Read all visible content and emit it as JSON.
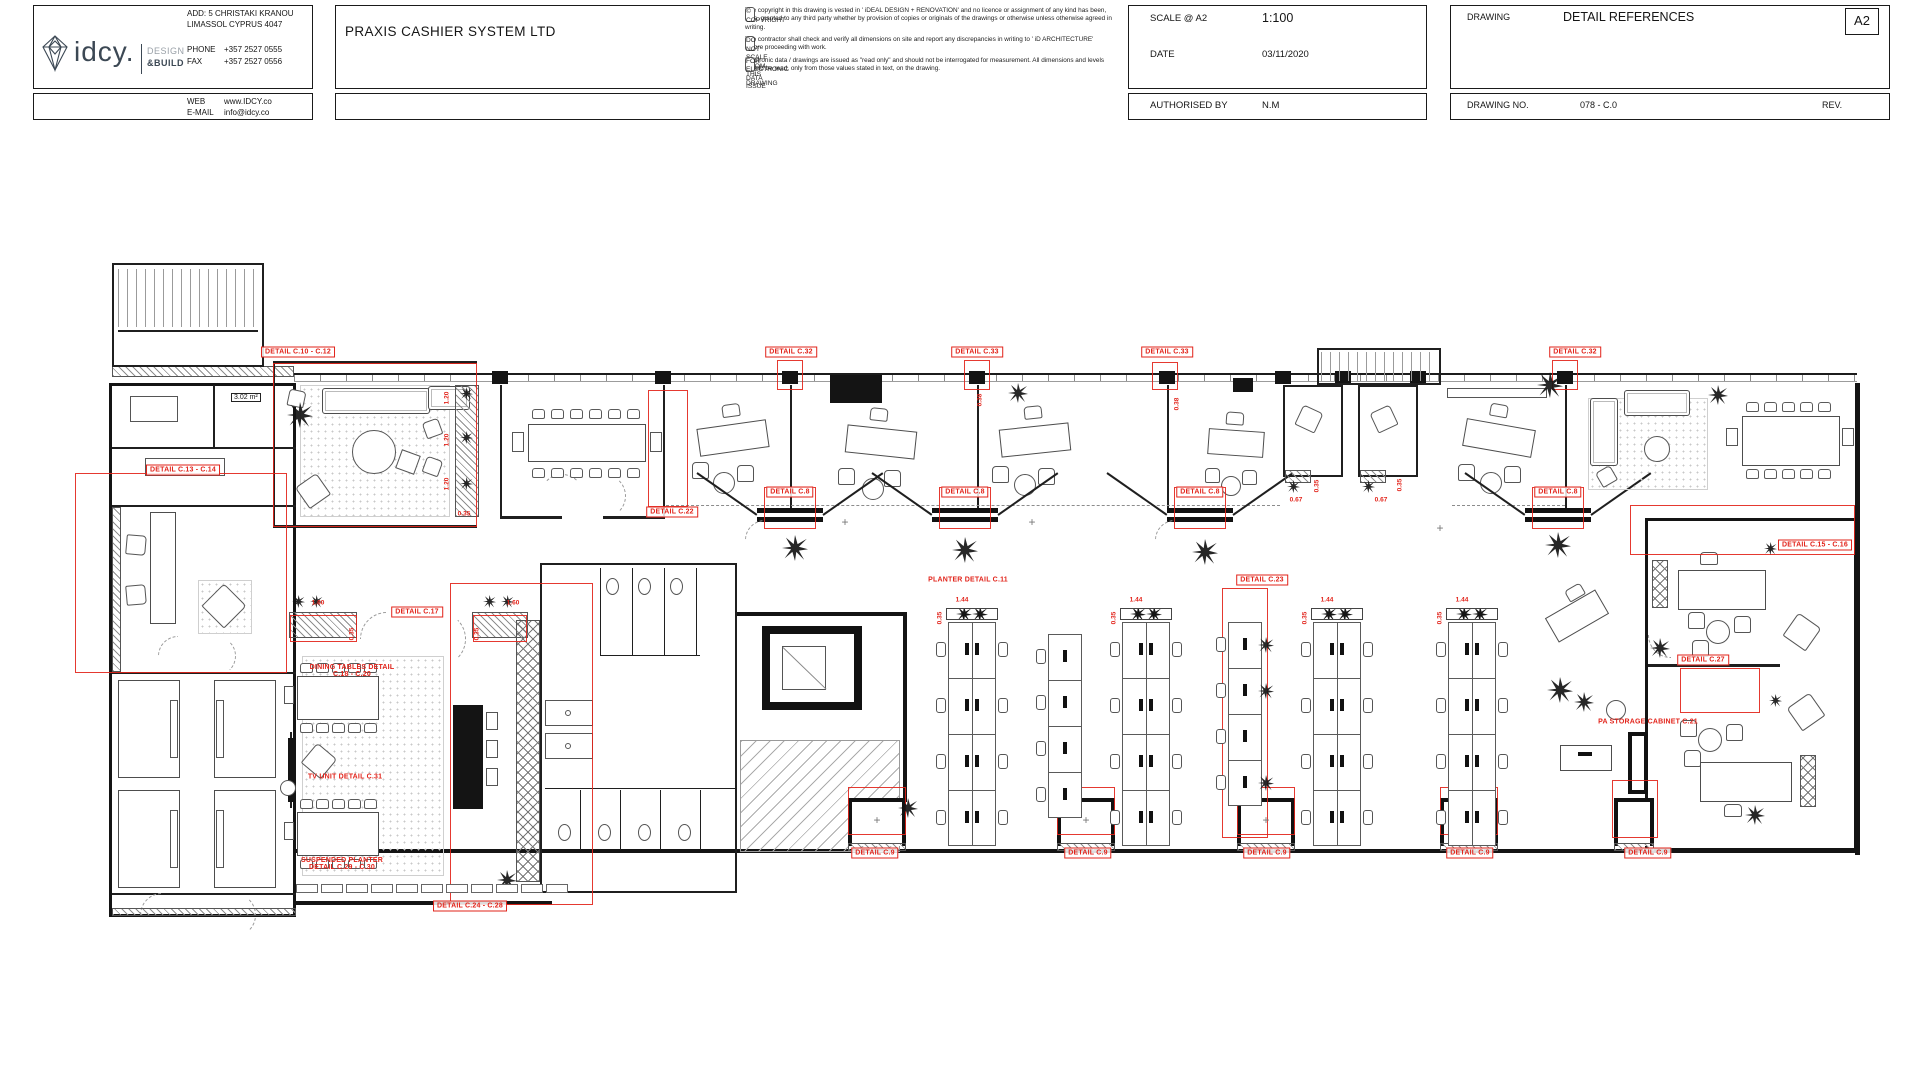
{
  "colors": {
    "annotation_red": "#e2231a",
    "wall_black": "#1a1a1a"
  },
  "brand": {
    "logo_text": "idcy.",
    "tag1": "DESIGN",
    "tag2": "&BUILD"
  },
  "contact": {
    "add1": "ADD: 5 CHRISTAKI KRANOU",
    "add2": "LIMASSOL CYPRUS 4047",
    "phone_label": "PHONE",
    "phone": "+357 2527 0555",
    "fax_label": "FAX",
    "fax": "+357 2527 0556",
    "web_label": "WEB",
    "web": "www.IDCY.co",
    "email_label": "E-MAIL",
    "email": "info@idcy.co"
  },
  "project": {
    "client": "PRAXIS CASHIER SYSTEM LTD"
  },
  "copyright": {
    "h1": "© COPYRIGHT",
    "p1": "The copyright in this drawing is vested in ' iDEAL DESIGN + RENOVATION'  and no licence or assignment of any kind has been, or is, granted to any third party whether by provision of copies or originals of the drawings or otherwise unless otherwise agreed in writing.",
    "h2": "DO NOT SCALE FROM THIS DRAWING",
    "p2": "The contractor shall check and verify all dimensions on site and report any discrepancies in writing to ' iD ARCHITECTURE' before proceeding with work.",
    "h3": "FOR ELECTRONIC DATA ISSUE",
    "p3": "Electronic data / drawings are issued as \"read only\" and should not be interrogated for measurement. All dimensions and levels should be read, only from those values stated in text, on the drawing."
  },
  "meta": {
    "scale_label": "SCALE @ A2",
    "scale": "1:100",
    "date_label": "DATE",
    "date": "03/11/2020",
    "auth_label": "AUTHORISED BY",
    "auth": "N.M",
    "drawing_label": "DRAWING",
    "drawing_title": "DETAIL REFERENCES",
    "size": "A2",
    "dno_label": "DRAWING NO.",
    "dno": "078 - C.0",
    "rev_label": "REV."
  },
  "plan": {
    "area_note": "3.02 m²",
    "labels": [
      [
        298,
        352,
        "DETAIL C.10 - C.12",
        1
      ],
      [
        183,
        470,
        "DETAIL C.13 - C.14",
        1
      ],
      [
        791,
        352,
        "DETAIL C.32",
        1
      ],
      [
        977,
        352,
        "DETAIL C.33",
        1
      ],
      [
        1167,
        352,
        "DETAIL C.33",
        1
      ],
      [
        1575,
        352,
        "DETAIL C.32",
        1
      ],
      [
        672,
        512,
        "DETAIL C.22",
        1
      ],
      [
        790,
        492,
        "DETAIL C.8",
        1
      ],
      [
        965,
        492,
        "DETAIL C.8",
        1
      ],
      [
        1200,
        492,
        "DETAIL C.8",
        1
      ],
      [
        1558,
        492,
        "DETAIL C.8",
        1
      ],
      [
        417,
        612,
        "DETAIL C.17",
        1
      ],
      [
        1262,
        580,
        "DETAIL C.23",
        1
      ],
      [
        875,
        853,
        "DETAIL C.9",
        1
      ],
      [
        1088,
        853,
        "DETAIL C.9",
        1
      ],
      [
        1267,
        853,
        "DETAIL C.9",
        1
      ],
      [
        1470,
        853,
        "DETAIL C.9",
        1
      ],
      [
        1648,
        853,
        "DETAIL C.9",
        1
      ],
      [
        470,
        906,
        "DETAIL C.24 - C.28",
        1
      ],
      [
        1703,
        660,
        "DETAIL C.27",
        1
      ],
      [
        1815,
        545,
        "DETAIL C.15 - C.16",
        1
      ],
      [
        968,
        580,
        "PLANTER DETAIL C.11",
        0
      ],
      [
        352,
        671,
        "DINING TABLES DETAIL\nC.18 - C.20",
        0
      ],
      [
        345,
        777,
        "TV UNIT DETAIL C.31",
        0
      ],
      [
        342,
        864,
        "SUSPENDED PLANTER\nDETAIL C.29 - C.30",
        0
      ],
      [
        1648,
        722,
        "PA STORAGE CABINET C.21",
        0
      ]
    ],
    "dims": [
      [
        447,
        398,
        "1.20",
        1
      ],
      [
        447,
        440,
        "1.20",
        1
      ],
      [
        447,
        484,
        "1.20",
        1
      ],
      [
        464,
        514,
        "0.35",
        0
      ],
      [
        318,
        603,
        "1.60",
        0
      ],
      [
        513,
        603,
        "1.60",
        0
      ],
      [
        352,
        634,
        "0.35",
        1
      ],
      [
        477,
        634,
        "0.35",
        1
      ],
      [
        980,
        400,
        "0.38",
        1
      ],
      [
        1177,
        404,
        "0.38",
        1
      ],
      [
        1296,
        500,
        "0.67",
        0
      ],
      [
        1381,
        500,
        "0.67",
        0
      ],
      [
        1317,
        486,
        "0.35",
        1
      ],
      [
        1400,
        485,
        "0.35",
        1
      ],
      [
        962,
        600,
        "1.44",
        0
      ],
      [
        1136,
        600,
        "1.44",
        0
      ],
      [
        1327,
        600,
        "1.44",
        0
      ],
      [
        1462,
        600,
        "1.44",
        0
      ],
      [
        940,
        618,
        "0.35",
        1
      ],
      [
        1114,
        618,
        "0.35",
        1
      ],
      [
        1305,
        618,
        "0.35",
        1
      ],
      [
        1440,
        618,
        "0.35",
        1
      ]
    ],
    "zones": [
      [
        273,
        363,
        204,
        164
      ],
      [
        75,
        473,
        212,
        200
      ],
      [
        290,
        615,
        67,
        27
      ],
      [
        473,
        615,
        54,
        27
      ],
      [
        450,
        583,
        143,
        322
      ],
      [
        1222,
        588,
        46,
        250
      ],
      [
        1680,
        668,
        80,
        45
      ],
      [
        1630,
        505,
        225,
        50
      ],
      [
        848,
        787,
        58,
        48
      ],
      [
        1057,
        787,
        58,
        48
      ],
      [
        1237,
        787,
        58,
        48
      ],
      [
        1440,
        787,
        58,
        48
      ],
      [
        1612,
        780,
        46,
        58
      ],
      [
        764,
        487,
        52,
        42
      ],
      [
        939,
        487,
        52,
        42
      ],
      [
        1174,
        487,
        52,
        42
      ],
      [
        1532,
        487,
        52,
        42
      ],
      [
        777,
        360,
        26,
        30
      ],
      [
        964,
        360,
        26,
        30
      ],
      [
        1152,
        362,
        26,
        28
      ],
      [
        1552,
        360,
        26,
        30
      ],
      [
        648,
        390,
        40,
        117
      ]
    ],
    "plants": [
      [
        300,
        415,
        2
      ],
      [
        466,
        393,
        0
      ],
      [
        466,
        437,
        0
      ],
      [
        466,
        483,
        0
      ],
      [
        795,
        548,
        2
      ],
      [
        965,
        550,
        2
      ],
      [
        1205,
        552,
        2
      ],
      [
        1558,
        545,
        2
      ],
      [
        1018,
        393,
        1
      ],
      [
        1550,
        385,
        2
      ],
      [
        1293,
        486,
        0
      ],
      [
        1368,
        486,
        0
      ],
      [
        908,
        808,
        1
      ],
      [
        1755,
        815,
        1
      ],
      [
        1770,
        548,
        0
      ],
      [
        1775,
        700,
        0
      ],
      [
        1660,
        648,
        1
      ],
      [
        1560,
        690,
        2
      ],
      [
        1584,
        702,
        1
      ],
      [
        507,
        880,
        1
      ],
      [
        298,
        601,
        0
      ],
      [
        316,
        601,
        0
      ],
      [
        489,
        601,
        0
      ],
      [
        507,
        601,
        0
      ],
      [
        1718,
        395,
        1
      ]
    ],
    "crosses": [
      [
        845,
        522
      ],
      [
        1032,
        522
      ],
      [
        1440,
        528
      ],
      [
        877,
        820
      ],
      [
        1086,
        820
      ],
      [
        1266,
        820
      ],
      [
        1469,
        820
      ]
    ],
    "banks": [
      {
        "x": 948,
        "y": 622,
        "cols": 2,
        "rows": 4,
        "planter": true
      },
      {
        "x": 1048,
        "y": 634,
        "cols": 1,
        "rows": 4
      },
      {
        "x": 1122,
        "y": 622,
        "cols": 2,
        "rows": 4,
        "planter": true
      },
      {
        "x": 1228,
        "y": 622,
        "cols": 1,
        "rows": 4,
        "plants": true
      },
      {
        "x": 1313,
        "y": 622,
        "cols": 2,
        "rows": 4,
        "planter": true
      },
      {
        "x": 1448,
        "y": 622,
        "cols": 2,
        "rows": 4,
        "planter": true
      }
    ]
  }
}
